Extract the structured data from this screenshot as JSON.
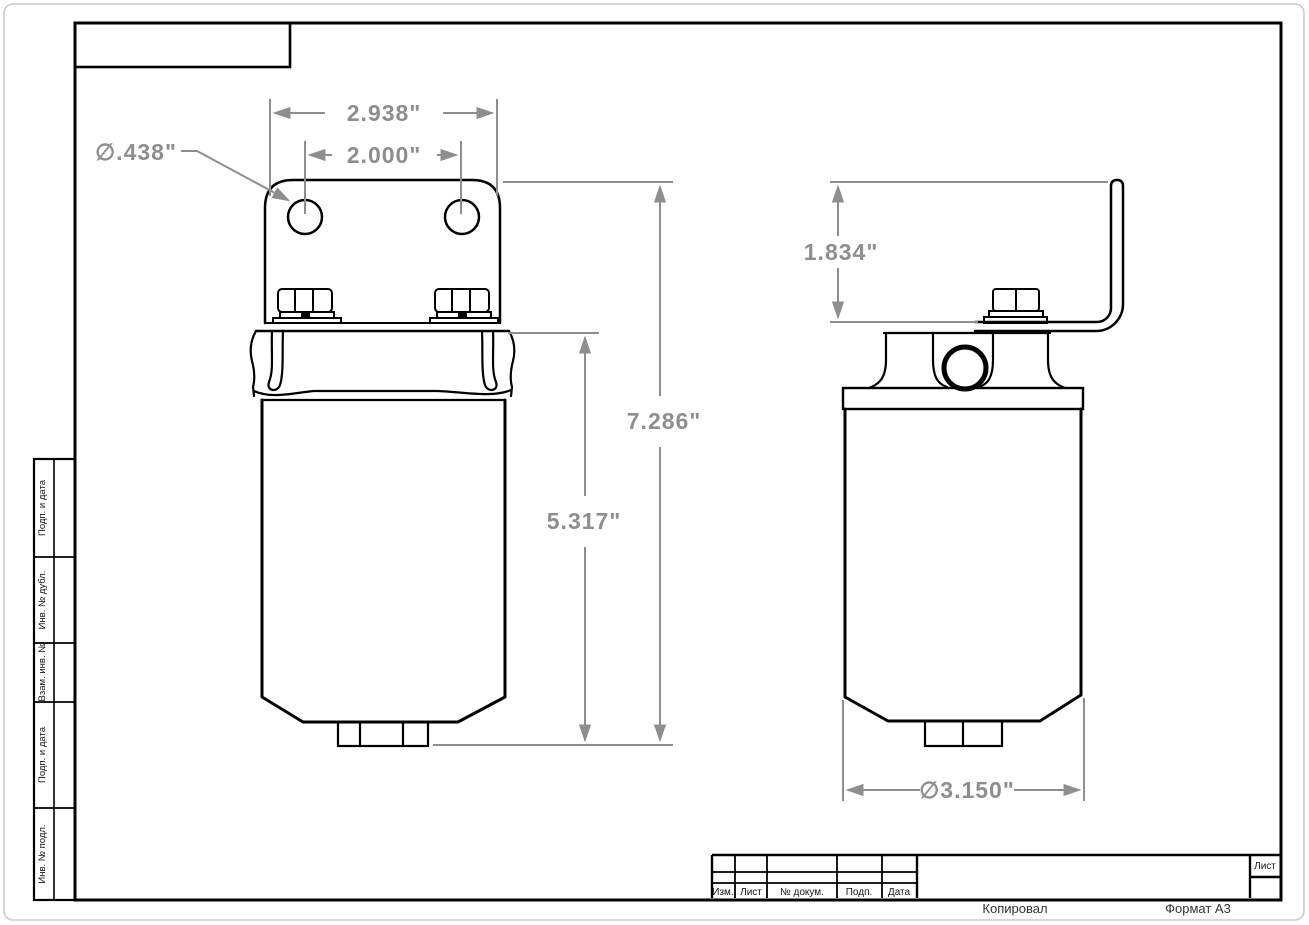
{
  "frame": {
    "sheet_label": "Лист",
    "copied_label": "Копировал",
    "format_label": "Формат А3"
  },
  "title_block": {
    "columns": [
      "Изм.",
      "Лист",
      "№ докум.",
      "Подп.",
      "Дата"
    ]
  },
  "side_stamp": {
    "labels": [
      "Подп. и дата",
      "Инв. № дубл.",
      "Взам. инв. №",
      "Подп. и дата",
      "Инв. № подл."
    ]
  },
  "drawing": {
    "views": [
      "front",
      "side"
    ],
    "part": "canister filter with mounting bracket",
    "dimensions": {
      "bracket_width": "2.938\"",
      "hole_spacing": "2.000\"",
      "hole_diameter": "∅.438\"",
      "overall_height": "7.286\"",
      "body_height": "5.317\"",
      "bracket_height": "1.834\"",
      "body_diameter": "∅3.150\""
    },
    "colors": {
      "outline": "#000000",
      "dimension": "#8e8e8e"
    }
  }
}
